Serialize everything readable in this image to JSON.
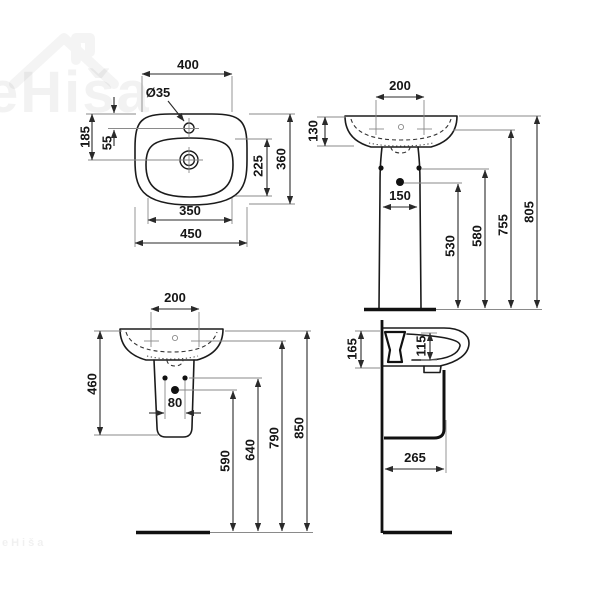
{
  "page": {
    "background": "#ffffff"
  },
  "watermark": {
    "text": "eHiša",
    "corner_text": "eHiša",
    "color": "rgba(0,0,0,0.05)"
  },
  "drawing": {
    "line_color": "#1b1b1b",
    "dim_color": "#2a2a2a",
    "ext_color": "#8a8a8a",
    "plan_view": {
      "dim_width_top": "400",
      "dim_tap_hole": "Ø35",
      "dim_back_to_drain": "185",
      "dim_back_to_tap": "55",
      "dim_bowl_depth": "225",
      "dim_overall_depth": "360",
      "dim_bowl_width": "350",
      "dim_overall_width": "450"
    },
    "front_pedestal_view": {
      "dim_tap_spacing": "200",
      "dim_rim_to_tap": "130",
      "dim_pedestal_width": "150",
      "dim_h_drain": "530",
      "dim_h_fixing": "580",
      "dim_h_tap": "755",
      "dim_h_rim": "805"
    },
    "front_semi_view": {
      "dim_tap_spacing": "200",
      "dim_unit_height": "460",
      "dim_fixing_spacing": "80",
      "dim_h_drain": "590",
      "dim_h_fixing": "640",
      "dim_h_tap": "790",
      "dim_h_rim": "850"
    },
    "side_view": {
      "dim_mount_height": "165",
      "dim_bowl_inner_depth": "115",
      "dim_projection": "265"
    }
  }
}
